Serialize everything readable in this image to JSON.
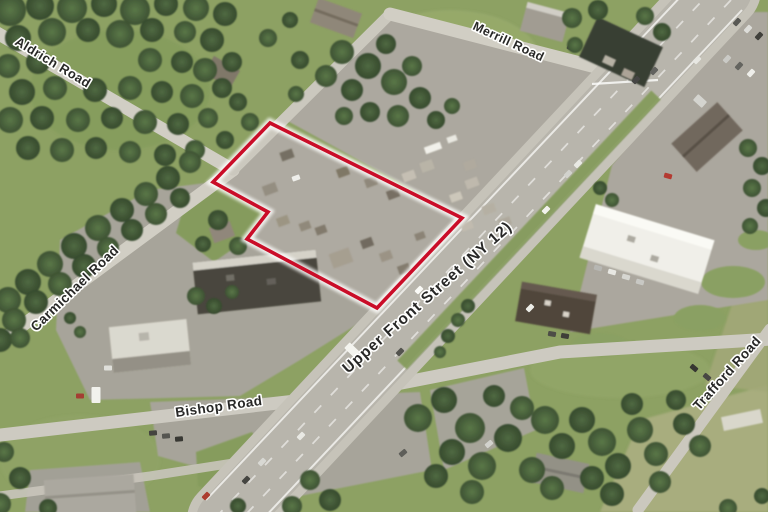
{
  "map": {
    "type": "aerial-photo",
    "description": "Oblique aerial photograph of a commercial corridor with a highlighted parcel outline",
    "road_labels": [
      {
        "name": "aldrich-road",
        "text": "Aldrich Road",
        "x": 14,
        "y": 44,
        "rotation": 31,
        "size": 13,
        "spacing": 0.4
      },
      {
        "name": "merrill-road",
        "text": "Merrill Road",
        "x": 472,
        "y": 29,
        "rotation": 25,
        "size": 12.5,
        "spacing": 0.4
      },
      {
        "name": "carmichael-road",
        "text": "Carmichael Road",
        "x": 36,
        "y": 332,
        "rotation": -44,
        "size": 13.5,
        "spacing": 0.4
      },
      {
        "name": "upper-front-street",
        "text": "Upper Front Street (NY 12)",
        "x": 348,
        "y": 374,
        "rotation": -41.5,
        "size": 15.5,
        "spacing": 1
      },
      {
        "name": "bishop-road",
        "text": "Bishop Road",
        "x": 176,
        "y": 417,
        "rotation": -8,
        "size": 13.5,
        "spacing": 0.4
      },
      {
        "name": "trafford-road",
        "text": "Trafford Road",
        "x": 699,
        "y": 411,
        "rotation": -48,
        "size": 13.5,
        "spacing": 0.4
      }
    ],
    "label_style": {
      "fill": "#1c1c1c",
      "halo": "#ffffff",
      "halo_width": 3.2
    },
    "parcel_outline": {
      "points": "270,123 213,182 268,212 247,239 377,308 462,218",
      "stroke_color": "#c8001e",
      "stroke_width": 3.6,
      "halo_color": "#ffffff",
      "halo_width": 9
    },
    "palette": {
      "grass": "#879c5c",
      "woods_dark": "#33492a",
      "highway": "#b5b2a9",
      "side_road": "#cfccc2",
      "pavement": "#a6a299",
      "red_outline": "#c8001e"
    }
  }
}
